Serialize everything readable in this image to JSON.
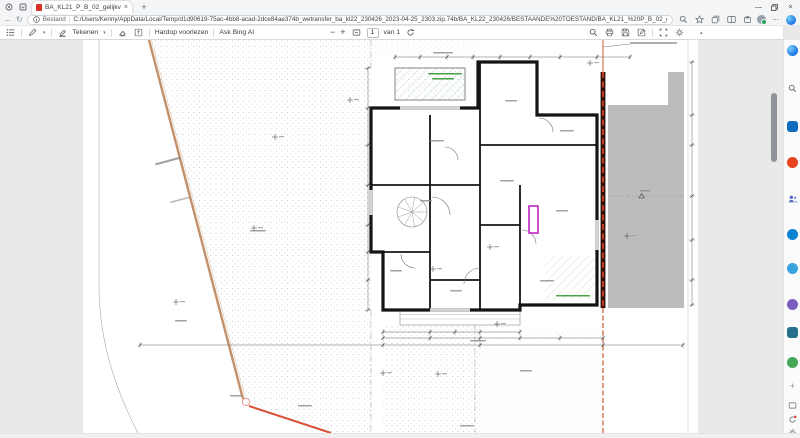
{
  "browser": {
    "tab": {
      "title": "BA_KL21_P_B_02_gelijkvloers 0...",
      "close_glyph": "×"
    },
    "new_tab_glyph": "+",
    "window_controls": {
      "minimize_glyph": "—",
      "close_glyph": "×"
    },
    "nav": {
      "back_glyph": "←",
      "refresh_glyph": "↻"
    },
    "address": {
      "scheme_label": "Bestand",
      "divider": "|",
      "url": "C:/Users/Kenny/AppData/Local/Temp/d1d90619-75ac-4bb8-acad-2dce84ae374b_wetransfer_ba_kl22_230426_2023-04-25_2303.zip.74b/BA_KL22_230426/BESTAANDE%20TOESTAND/BA_KL21_%20P_B_02_gelijkvloers%2000.pdf"
    }
  },
  "pdf_toolbar": {
    "draw_label": "Tekenen",
    "read_aloud_label": "Hardop voorlezen",
    "ask_bing_label": "Ask Bing AI",
    "zoom_out_glyph": "−",
    "zoom_in_glyph": "+",
    "page_number": "1",
    "page_total_label": "van 1"
  },
  "sidebar_icons": [
    "copilot",
    "search",
    "drop",
    "shopping",
    "people",
    "skype",
    "outlook",
    "m365",
    "designer",
    "games",
    "add",
    "screenshot",
    "feedback",
    "settings"
  ],
  "toolbar_icons": [
    "toc",
    "pen",
    "highlighter",
    "eraser",
    "add-text",
    "read-aloud",
    "search",
    "print",
    "save",
    "edit",
    "fit-page",
    "rotate",
    "more",
    "collapse"
  ],
  "colors": {
    "accent_blue": "#1a73e8",
    "viewer_background": "#e9e9e9",
    "boundary_tan": "#c2906a",
    "boundary_red": "#d94f35",
    "property_line_red": "#c13a22",
    "annotation_green": "#3f9b3f",
    "highlight_magenta": "#c026c0",
    "neighbor_gray": "#bcbcbc",
    "wall_black": "#141414"
  }
}
